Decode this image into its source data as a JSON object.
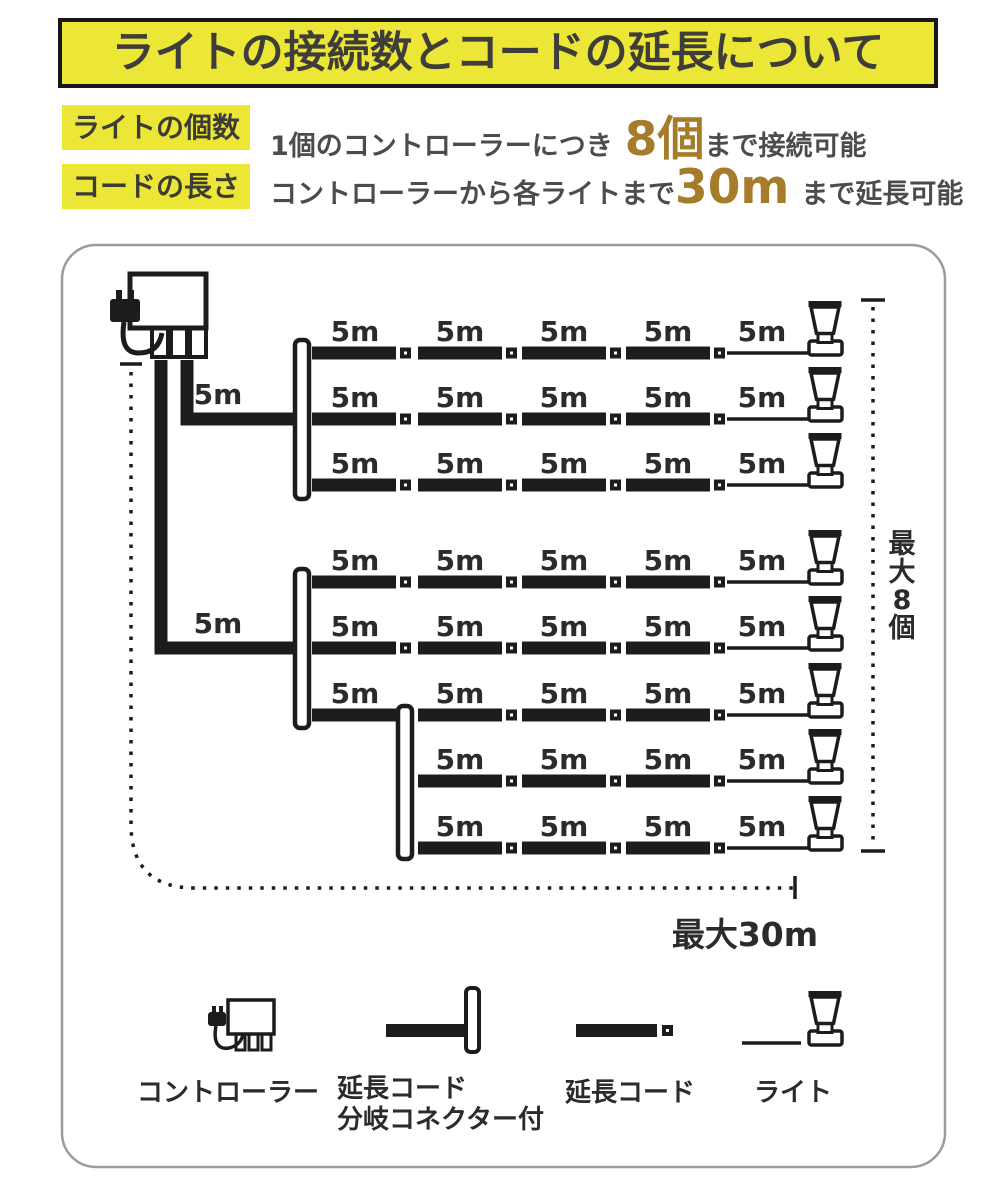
{
  "header": {
    "title": "ライトの接続数とコードの延長について"
  },
  "specs": {
    "rows": [
      {
        "label": "ライトの個数",
        "pre": "1個のコントローラーにつき",
        "highlight": "8個",
        "post": "まで接続可能"
      },
      {
        "label": "コードの長さ",
        "pre": "コントローラーから各ライトまで",
        "highlight": "30m",
        "post": "まで延長可能"
      }
    ]
  },
  "colors": {
    "accent_yellow": "#ece636",
    "highlight_gold": "#a67c2b",
    "ink": "#1c1c1c",
    "text_dark": "#454440",
    "box_border": "#9b9b9b"
  },
  "diagram": {
    "type": "connection-diagram",
    "segment_label": "5m",
    "max_lights_label": "最大8個",
    "max_length_label": "最大30m",
    "lights_total": 8,
    "feeds": [
      {
        "label": "5m",
        "vx": 187,
        "hy": 419,
        "hx2": 298,
        "label_x": 218,
        "label_y": 404
      },
      {
        "label": "5m",
        "vx": 161,
        "hy": 648,
        "hx2": 298,
        "label_x": 218,
        "label_y": 633
      }
    ],
    "brackets": [
      {
        "x": 302,
        "y1": 340,
        "y2": 499
      },
      {
        "x": 302,
        "y1": 569,
        "y2": 728
      },
      {
        "x": 405,
        "y1": 706,
        "y2": 859
      }
    ],
    "rows": [
      {
        "y": 353,
        "cols": [
          1,
          2,
          3,
          4,
          5
        ]
      },
      {
        "y": 419,
        "cols": [
          1,
          2,
          3,
          4,
          5
        ]
      },
      {
        "y": 485,
        "cols": [
          1,
          2,
          3,
          4,
          5
        ]
      },
      {
        "y": 582,
        "cols": [
          1,
          2,
          3,
          4,
          5
        ]
      },
      {
        "y": 648,
        "cols": [
          1,
          2,
          3,
          4,
          5
        ]
      },
      {
        "y": 715,
        "cols": [
          1,
          2,
          3,
          4,
          5
        ],
        "skip_square_after_col": 1
      },
      {
        "y": 781,
        "cols": [
          2,
          3,
          4,
          5
        ]
      },
      {
        "y": 848,
        "cols": [
          2,
          3,
          4,
          5
        ]
      }
    ]
  },
  "legend": {
    "items": [
      {
        "icon": "controller-icon",
        "label": "コントローラー"
      },
      {
        "icon": "branch-connector-cord-icon",
        "label": "延長コード",
        "label_line2": "分岐コネクター付"
      },
      {
        "icon": "extension-cord-icon",
        "label": "延長コード"
      },
      {
        "icon": "light-icon",
        "label": "ライト"
      }
    ]
  }
}
